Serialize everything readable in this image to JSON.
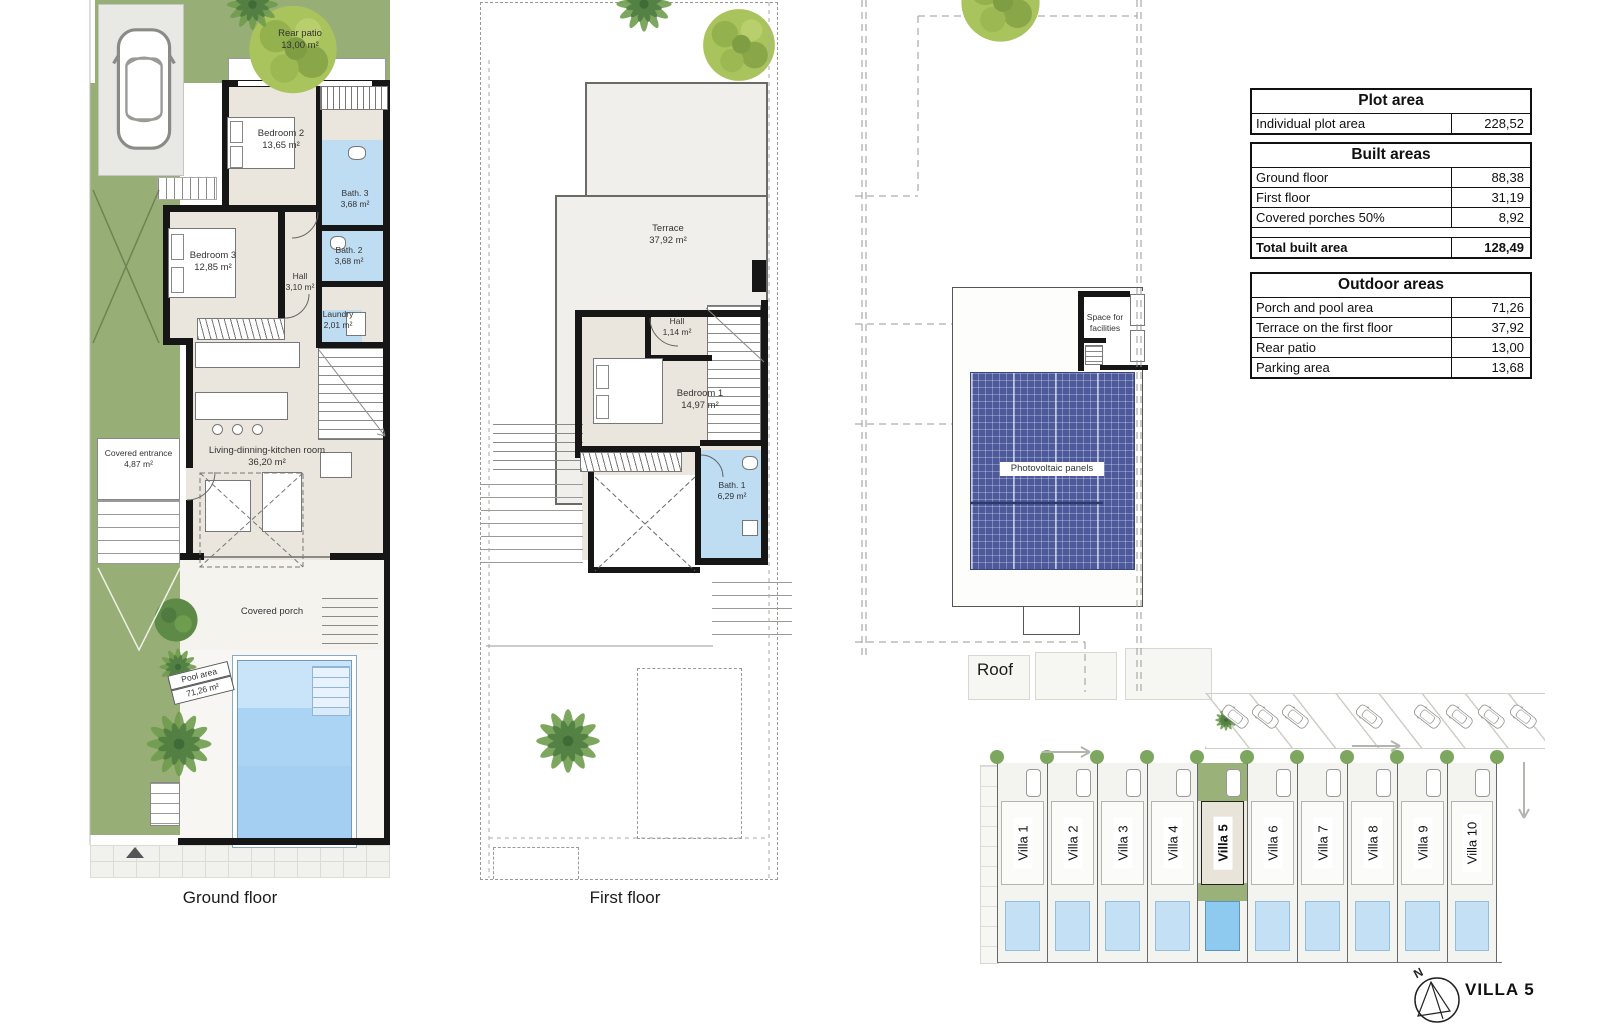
{
  "colors": {
    "grass": "#98ae77",
    "floor_beige": "#eae6dd",
    "bath_blue": "#bedcf2",
    "pool_blue": "#a9d2f3",
    "photovoltaic_blue": "#4c599b",
    "wall": "#161616"
  },
  "floors": {
    "ground": {
      "label": "Ground floor",
      "rooms": {
        "rear_patio": {
          "name": "Rear patio",
          "area": "13,00 m²"
        },
        "bedroom2": {
          "name": "Bedroom 2",
          "area": "13,65 m²"
        },
        "bath3": {
          "name": "Bath. 3",
          "area": "3,68 m²"
        },
        "bedroom3": {
          "name": "Bedroom 3",
          "area": "12,85 m²"
        },
        "bath2": {
          "name": "Bath. 2",
          "area": "3,68 m²"
        },
        "hall": {
          "name": "Hall",
          "area": "3,10 m²"
        },
        "laundry": {
          "name": "Laundry",
          "area": "2,01 m²"
        },
        "living": {
          "name": "Living-dinning-kitchen room",
          "area": "36,20 m²"
        },
        "covered_entrance": {
          "name": "Covered entrance",
          "area": "4,87 m²"
        },
        "covered_porch": {
          "name": "Covered porch"
        },
        "pool": {
          "name": "Pool area",
          "area": "71,26 m²"
        }
      }
    },
    "first": {
      "label": "First floor",
      "rooms": {
        "terrace": {
          "name": "Terrace",
          "area": "37,92 m²"
        },
        "hall": {
          "name": "Hall",
          "area": "1,14 m²"
        },
        "bedroom1": {
          "name": "Bedroom 1",
          "area": "14,97 m²"
        },
        "bath1": {
          "name": "Bath. 1",
          "area": "6,29 m²"
        }
      }
    },
    "roof": {
      "label": "Roof",
      "annotations": {
        "space_for_facilities": "Space for facilities",
        "photovoltaic_panels": "Photovoltaic panels"
      }
    }
  },
  "tables": {
    "plot": {
      "title": "Plot area",
      "rows": [
        {
          "label": "Individual plot area",
          "value": "228,52"
        }
      ]
    },
    "built": {
      "title": "Built areas",
      "rows": [
        {
          "label": "Ground floor",
          "value": "88,38"
        },
        {
          "label": "First floor",
          "value": "31,19"
        },
        {
          "label": "Covered porches 50%",
          "value": "8,92"
        }
      ],
      "total": {
        "label": "Total built area",
        "value": "128,49"
      }
    },
    "outdoor": {
      "title": "Outdoor areas",
      "rows": [
        {
          "label": "Porch and pool area",
          "value": "71,26"
        },
        {
          "label": "Terrace on the first floor",
          "value": "37,92"
        },
        {
          "label": "Rear patio",
          "value": "13,00"
        },
        {
          "label": "Parking area",
          "value": "13,68"
        }
      ]
    }
  },
  "site_plan": {
    "villas": [
      {
        "label": "Villa 1"
      },
      {
        "label": "Villa 2"
      },
      {
        "label": "Villa 3"
      },
      {
        "label": "Villa 4"
      },
      {
        "label": "Villa 5",
        "highlight": true
      },
      {
        "label": "Villa 6"
      },
      {
        "label": "Villa 7"
      },
      {
        "label": "Villa 8"
      },
      {
        "label": "Villa 9"
      },
      {
        "label": "Villa 10"
      }
    ]
  },
  "title_block": {
    "villa_name": "VILLA 5",
    "compass_north": "N"
  }
}
